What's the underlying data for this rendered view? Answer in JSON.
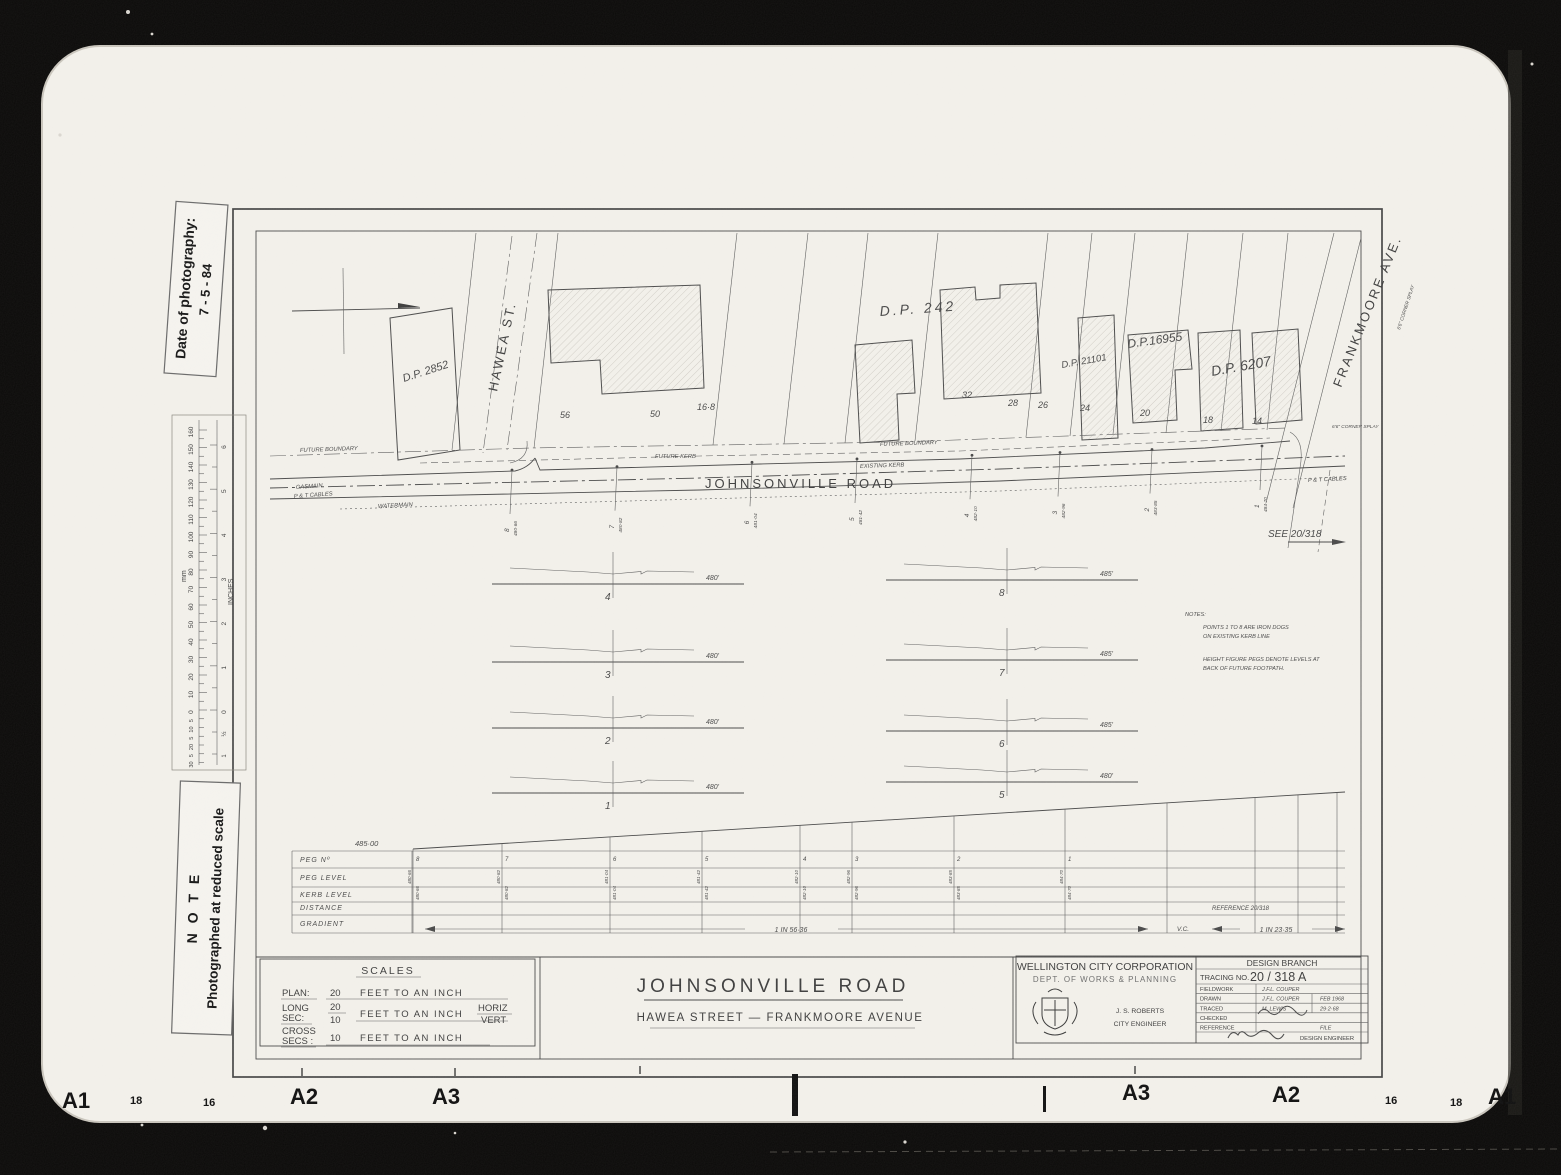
{
  "film": {
    "markers_left": [
      "A1",
      "18",
      "16",
      "A2",
      "A3"
    ],
    "markers_right": [
      "A3",
      "A2",
      "16",
      "18",
      "A1"
    ]
  },
  "stamps": {
    "date_title": "Date of photography:",
    "date_value": "7 - 5 - 84",
    "note_title": "N O T E",
    "note_text": "Photographed at reduced scale"
  },
  "ruler": {
    "mm_label": "mm",
    "inches_label": "INCHES",
    "mm_major": [
      "160",
      "150",
      "140",
      "130",
      "120",
      "110",
      "100",
      "90",
      "80",
      "70",
      "60",
      "50",
      "40",
      "30",
      "20",
      "10",
      "0"
    ],
    "mm_sub": [
      "5",
      "10",
      "5",
      "20",
      "5",
      "30"
    ],
    "inch_major": [
      "6",
      "5",
      "4",
      "3",
      "2",
      "1",
      "0"
    ],
    "inch_sub": [
      "½",
      "1"
    ]
  },
  "plan": {
    "road_label": "JOHNSONVILLE  ROAD",
    "hawea": "HAWEA  ST.",
    "frankmoore": "FRANKMOORE  AVE.",
    "dp": [
      "D.P. 2852",
      "D.P. 242",
      "D.P. 21101",
      "D.P.16955",
      "D.P. 6207"
    ],
    "lots": [
      "56",
      "50",
      "16·8",
      "32",
      "28",
      "26",
      "24",
      "20",
      "18",
      "14"
    ],
    "ann": {
      "future_boundary": "FUTURE BOUNDARY",
      "future_kerb": "FUTURE KERB",
      "existing_kerb": "EXISTING KERB",
      "gasmain": "GASMAIN",
      "watermain": "WATERMAIN",
      "pt_cables": "P & T CABLES",
      "corner_splay": "6'6\" CORNER SPLAY",
      "see_ref": "SEE  20/318"
    },
    "pegs": [
      {
        "no": "8",
        "lvl": "480·66"
      },
      {
        "no": "7",
        "lvl": "480·82"
      },
      {
        "no": "6",
        "lvl": "481·04"
      },
      {
        "no": "5",
        "lvl": "481·42"
      },
      {
        "no": "4",
        "lvl": "482·10"
      },
      {
        "no": "3",
        "lvl": "482·96"
      },
      {
        "no": "2",
        "lvl": "483·85"
      },
      {
        "no": "1",
        "lvl": "484·70"
      }
    ]
  },
  "sections": {
    "left": [
      {
        "no": "4",
        "datum": "480'"
      },
      {
        "no": "3",
        "datum": "480'"
      },
      {
        "no": "2",
        "datum": "480'"
      },
      {
        "no": "1",
        "datum": "480'"
      }
    ],
    "right": [
      {
        "no": "8",
        "datum": "485'"
      },
      {
        "no": "7",
        "datum": "485'"
      },
      {
        "no": "6",
        "datum": "485'"
      },
      {
        "no": "5",
        "datum": "480'"
      }
    ]
  },
  "notes": {
    "title": "NOTES:",
    "l1a": "POINTS  1  TO  8  ARE  IRON  DOGS",
    "l1b": "ON  EXISTING  KERB  LINE",
    "l2a": "HEIGHT  FIGURE  PEGS  DENOTE  LEVELS  AT",
    "l2b": "BACK  OF  FUTURE  FOOTPATH."
  },
  "long_section": {
    "datum": "485·00",
    "row_labels": [
      "PEG  Nº",
      "PEG  LEVEL",
      "KERB  LEVEL",
      "DISTANCE",
      "GRADIENT"
    ],
    "gradient_left": "1  IN  56·36",
    "vc": "V.C.",
    "gradient_right": "1  IN  23·35",
    "reference": "REFERENCE   20/318"
  },
  "scales": {
    "title": "SCALES",
    "plan_label": "PLAN:",
    "plan_value": "20",
    "plan_unit": "FEET  TO  AN  INCH",
    "long_label1": "LONG",
    "long_label2": "SEC:",
    "long_num": "20",
    "long_den": "10",
    "long_unit": "FEET  TO  AN  INCH",
    "long_h": "HORIZ",
    "long_v": "VERT",
    "cross_label1": "CROSS",
    "cross_label2": "SECS :",
    "cross_value": "10",
    "cross_unit": "FEET  TO  AN  INCH"
  },
  "titles": {
    "road": "JOHNSONVILLE  ROAD",
    "subtitle": "HAWEA  STREET —  FRANKMOORE  AVENUE"
  },
  "title_block": {
    "corp": "WELLINGTON CITY CORPORATION",
    "dept": "DEPT. OF  WORKS  &  PLANNING",
    "engineer_name": "J. S. ROBERTS",
    "engineer_title": "CITY ENGINEER",
    "branch": "DESIGN BRANCH",
    "tracing_label": "TRACING NO.",
    "tracing_no": "20 / 318  A",
    "rows": [
      {
        "label": "FIELDWORK",
        "value": "J.F.L. COUPER",
        "extra": ""
      },
      {
        "label": "DRAWN",
        "value": "J.F.L. COUPER",
        "extra": "FEB 1968"
      },
      {
        "label": "TRACED",
        "value": "M. LEWIS",
        "extra": "29·2·68"
      },
      {
        "label": "CHECKED",
        "value": "",
        "extra": ""
      },
      {
        "label": "REFERENCE",
        "value": "",
        "extra": "FILE"
      }
    ],
    "design_engineer": "DESIGN ENGINEER"
  }
}
